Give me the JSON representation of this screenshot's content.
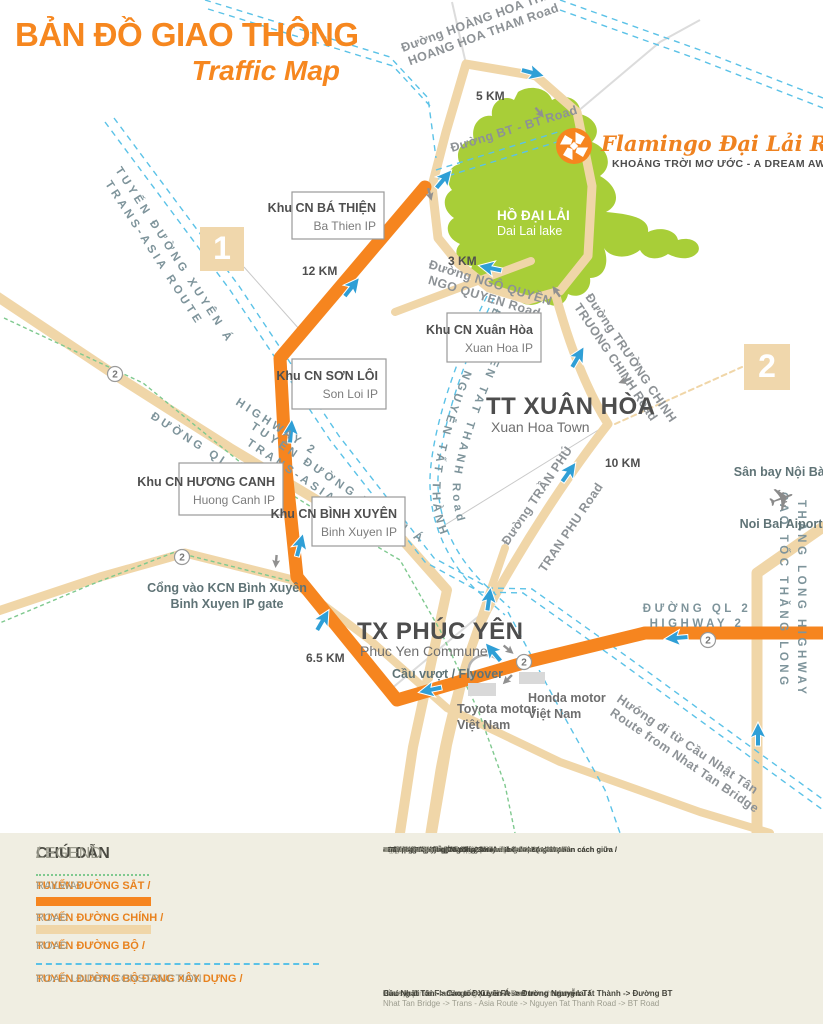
{
  "header": {
    "title_vi": "BẢN ĐỒ GIAO THÔNG",
    "title_en": "Traffic Map"
  },
  "resort": {
    "name": "Flamingo Đại Lải Resort",
    "tagline": "KHOẢNG TRỜI MƠ ƯỚC - A DREAM AWAY"
  },
  "map": {
    "lake": {
      "vi": "HỒ ĐẠI LẢI",
      "en": "Dai Lai lake"
    },
    "towns": {
      "xuan_hoa": {
        "vi": "TT XUÂN HÒA",
        "en": "Xuan Hoa Town"
      },
      "phuc_yen": {
        "vi": "TX PHÚC YÊN",
        "en": "Phuc Yen Commune"
      }
    },
    "industrial_parks": {
      "ba_thien": {
        "vi": "Khu CN BÁ THIỆN",
        "en": "Ba Thien IP"
      },
      "son_loi": {
        "vi": "Khu CN SƠN LÔI",
        "en": "Son Loi IP"
      },
      "xuan_hoa": {
        "vi": "Khu CN Xuân Hòa",
        "en": "Xuan Hoa IP"
      },
      "huong_canh": {
        "vi": "Khu CN HƯƠNG CANH",
        "en": "Huong Canh IP"
      },
      "binh_xuyen": {
        "vi": "Khu CN BÌNH XUYÊN",
        "en": "Binh Xuyen IP"
      }
    },
    "roads": {
      "hoang_hoa_tham": {
        "vi": "Đường HOÀNG HOA THÁM",
        "en": "HOANG HOA THAM Road"
      },
      "bt": {
        "label": "Đường BT - BT Road"
      },
      "ngo_quyen": {
        "vi": "Đường NGÔ QUYỀN",
        "en": "NGO QUYEN Road"
      },
      "truong_chinh": {
        "vi": "Đường TRƯỜNG CHINH",
        "en": "TRUONG CHINH Road"
      },
      "nguyen_tat_thanh": {
        "vi": "ĐƯỜNG NGUYỄN TẤT THÀNH",
        "en": "NGUYEN TAT THANH Road"
      },
      "trans_asia": {
        "vi": "TUYẾN ĐƯỜNG XUYÊN Á",
        "en": "TRANS-ASIA ROUTE"
      },
      "tran_phu": {
        "vi": "Đường TRẦN PHÚ",
        "en": "TRAN PHU Road"
      },
      "highway2": {
        "vi": "ĐƯỜNG QL 2",
        "en": "HIGHWAY 2"
      },
      "thang_long": {
        "vi": "CAO TỐC THĂNG LONG",
        "en": "THANG LONG HIGHWAY"
      },
      "nhat_tan": {
        "vi": "Hướng đi từ Cầu Nhật Tân",
        "en": "Route from Nhat Tan Bridge"
      }
    },
    "pois": {
      "airport": {
        "vi": "Sân bay Nội Bài",
        "en": "Noi Bai Aiport"
      },
      "gate": {
        "vi": "Cổng vào KCN Bình Xuyên",
        "en": "Binh Xuyen IP gate"
      },
      "flyover": {
        "label": "Cầu vượt / Flyover"
      },
      "toyota": {
        "line1": "Toyota motor",
        "line2": "Việt Nam"
      },
      "honda": {
        "line1": "Honda motor",
        "line2": "Việt Nam"
      }
    },
    "distances": {
      "km5": "5 KM",
      "km12": "12 KM",
      "km3": "3 KM",
      "km10": "10 KM",
      "km65": "6.5 KM"
    },
    "badges": {
      "b1": "1",
      "b2": "2"
    },
    "route_shield": "2"
  },
  "legend": {
    "title_vi": "CHÚ DẪN",
    "title_sep": " / ",
    "title_en": "LEGEND",
    "items": [
      {
        "vi": "TUYẾN ĐƯỜNG SẮT / ",
        "en": "RAILWAY"
      },
      {
        "vi": "TUYẾN ĐƯỜNG CHÍNH / ",
        "en": "ROAD"
      },
      {
        "vi": "TUYẾN ĐƯỜNG BỘ / ",
        "en": "ROAD"
      },
      {
        "vi": "TUYẾN ĐƯỜNG BỘ ĐANG XÂY DỰNG / ",
        "en": "ROAD UNDER CONSTRUCTION"
      }
    ]
  },
  "notes": [
    {
      "vi": "1. Đường BT đang chuẩn bị xây dựng / ",
      "en": "BT Road will be constructed"
    },
    {
      "vi": "- Độ dài: 3km / ",
      "en": "Length: 3km"
    },
    {
      "vi": "2. Đường Nguyễn Tất Thành - Hoàn thành Q1/2011 / ",
      "en": "Nguyen Tat Thanh Road will be completed in Q1-2011"
    },
    {
      "vi": "- Đường 4 làn xe cơ giới, 2 làn xe thô sơ, có giải phân cách giữa / ",
      "en": "4-lane vehicle, 2-lane non-motor, with central reservation"
    },
    {
      "vi": "- Mặt đường rộng 20m / ",
      "en": "20m wide road surface"
    },
    {
      "vi": "- Giải phân cách giữa rộng 3m / ",
      "en": "3m wide central reservation"
    },
    {
      "vi": "3. Cao tốc Xuyên Á - Hoàn thành năm 2013 / ",
      "en": "Trans-Asia Route will be completed in 2013"
    },
    {
      "vi": "- Đường cao tốc / ",
      "en": "Highway"
    },
    {
      "vi": "- Mặt đường rộng 24m / ",
      "en": "24m wide road surface"
    },
    {
      "vi": "4. Đường từ Cầu Nhật Tân - Hoàn thành năm 2014 / ",
      "en": "Route from Nhat Tan Bridge will be completed in 2014"
    },
    {
      "vi": "- Đường 4 làn xe cơ giới, 2 làn xe thô sơ, có giải phân cách giữa / ",
      "en": "4-lane vehicle, 2-lane non-motor, with central reservation"
    },
    {
      "vi": "- Mặt đường rộng 20m / ",
      "en": "20m wide road surface"
    },
    {
      "vi": "- Dải phân cách giữa rộng 3m / ",
      "en": "3m wide median"
    }
  ],
  "future": {
    "head_vi": "Hướng đi tới Flamingo Đại Lải Resort trong tương lai / ",
    "head_en": "Transport route to Flamingo Dai Lai Resort in the future",
    "route_vi": "Cầu Nhật Tân  ->  Cao tốc Xuyên Á  ->  Đường Nguyễn Tất Thành  ->  Đường BT",
    "route_en": "Nhat Tan Bridge  ->  Trans - Asia Route  ->  Nguyen Tat Thanh Road  ->  BT Road"
  },
  "colors": {
    "accent_orange": "#F6851F",
    "road_tan": "#F0D6A8",
    "lake_green": "#A8CE38",
    "arrow_blue": "#2F9FD6",
    "construction_blue": "#5BC2E7",
    "railway_green": "#7FC98F",
    "legend_bg": "#F0EEE2"
  }
}
